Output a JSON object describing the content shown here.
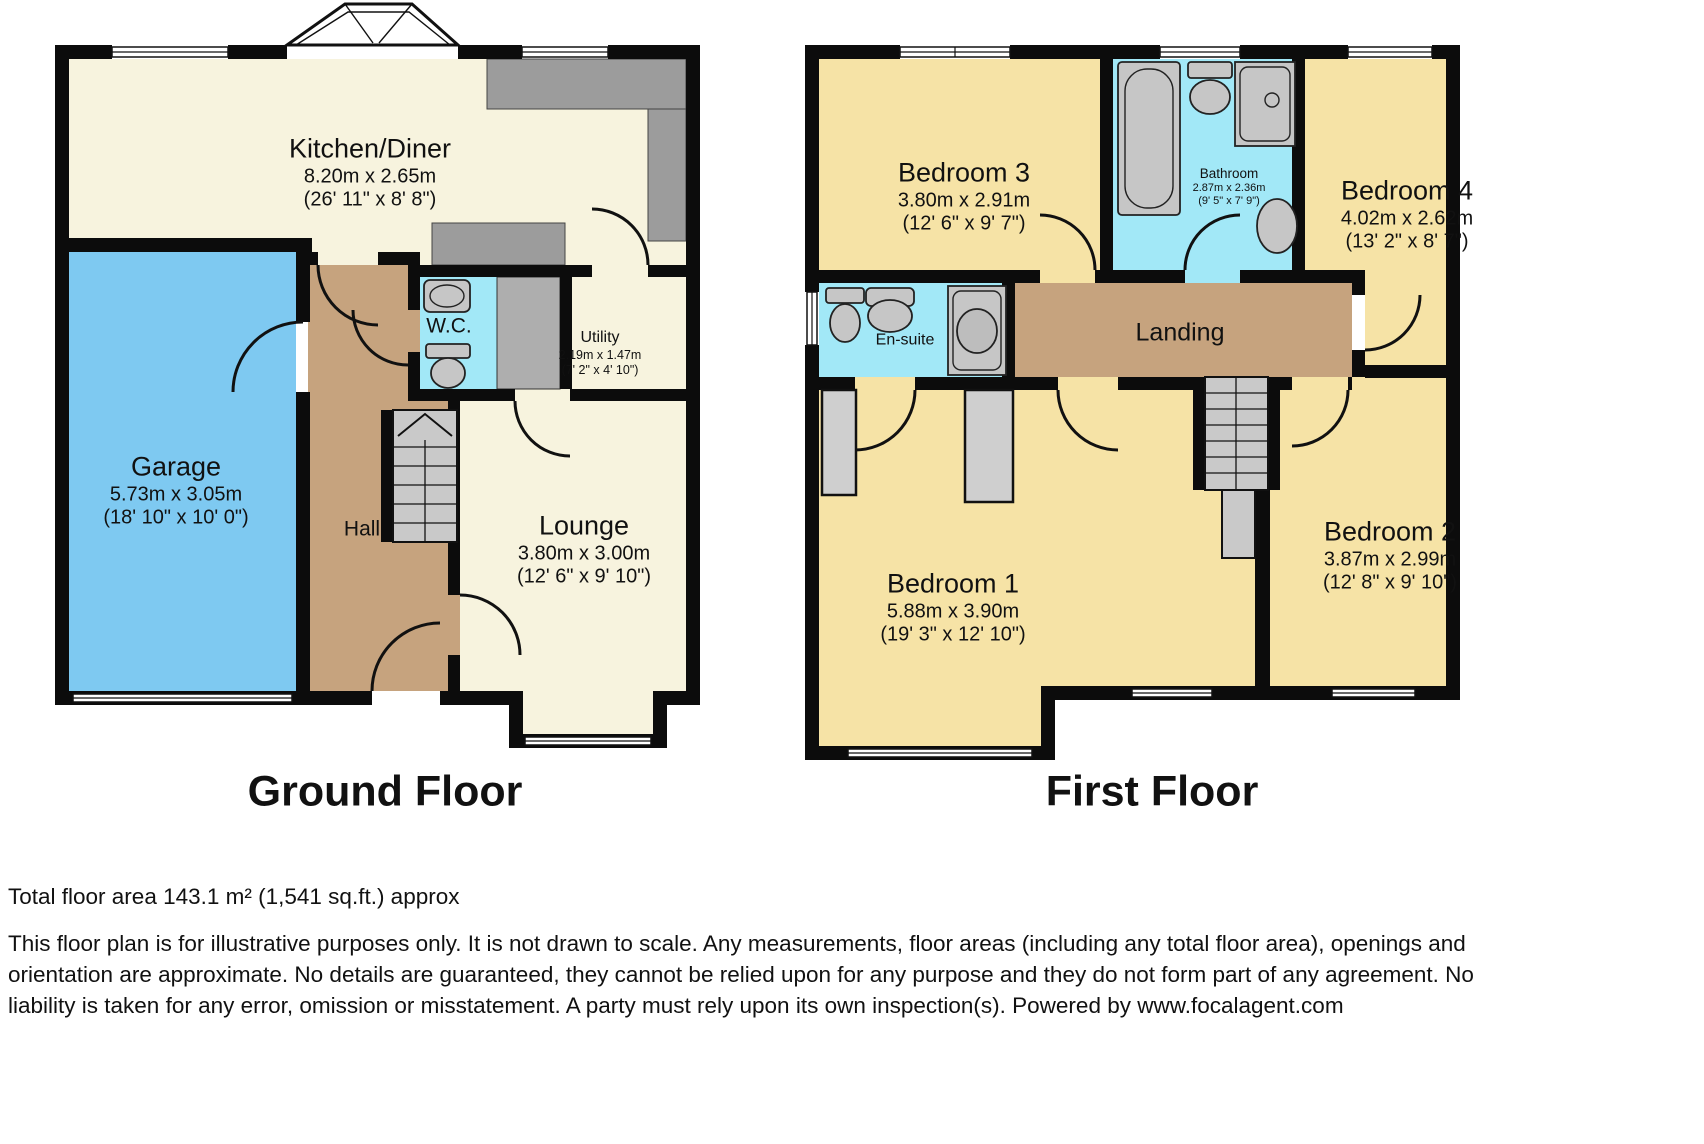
{
  "colors": {
    "wall": "#0c0c0c",
    "cream": "#f7f3de",
    "yellow": "#f6e3a6",
    "blue": "#7ec9f1",
    "cyan": "#a2e8f7",
    "tan": "#c6a37e",
    "fixture": "#c6c6c6",
    "counter": "#9c9c9c",
    "stairs": "#c9c9c9",
    "appliance": "#aeaeae",
    "text": "#111111"
  },
  "floors": {
    "ground": {
      "title": "Ground Floor",
      "rooms": {
        "kitchen": {
          "name": "Kitchen/Diner",
          "metric": "8.20m x 2.65m",
          "imperial": "(26' 11\" x 8' 8\")"
        },
        "garage": {
          "name": "Garage",
          "metric": "5.73m x 3.05m",
          "imperial": "(18' 10\" x 10' 0\")"
        },
        "wc": {
          "name": "W.C."
        },
        "utility": {
          "name": "Utility",
          "metric": "2.19m x 1.47m",
          "imperial": "(7' 2\" x 4' 10\")"
        },
        "hall": {
          "name": "Hall"
        },
        "lounge": {
          "name": "Lounge",
          "metric": "3.80m x 3.00m",
          "imperial": "(12' 6\" x 9' 10\")"
        }
      }
    },
    "first": {
      "title": "First Floor",
      "rooms": {
        "bedroom3": {
          "name": "Bedroom 3",
          "metric": "3.80m x 2.91m",
          "imperial": "(12' 6\" x 9' 7\")"
        },
        "bathroom": {
          "name": "Bathroom",
          "metric": "2.87m x 2.36m",
          "imperial": "(9' 5\" x 7' 9\")"
        },
        "bedroom4": {
          "name": "Bedroom 4",
          "metric": "4.02m x 2.62m",
          "imperial": "(13' 2\" x 8' 7\")"
        },
        "ensuite": {
          "name": "En-suite"
        },
        "landing": {
          "name": "Landing"
        },
        "bedroom1": {
          "name": "Bedroom 1",
          "metric": "5.88m x 3.90m",
          "imperial": "(19' 3\" x 12' 10\")"
        },
        "bedroom2": {
          "name": "Bedroom 2",
          "metric": "3.87m x 2.99m",
          "imperial": "(12' 8\" x 9' 10\")"
        }
      }
    }
  },
  "footer": {
    "total_area": "Total floor area 143.1 m² (1,541 sq.ft.) approx",
    "disclaimer": "This floor plan is for illustrative purposes only. It is not drawn to scale. Any measurements, floor areas (including any total floor area), openings and orientation are approximate. No details are guaranteed, they cannot be relied upon for any purpose and they do not form part of any agreement. No liability is taken for any error, omission or misstatement. A party must rely upon its own inspection(s). Powered by www.focalagent.com"
  }
}
